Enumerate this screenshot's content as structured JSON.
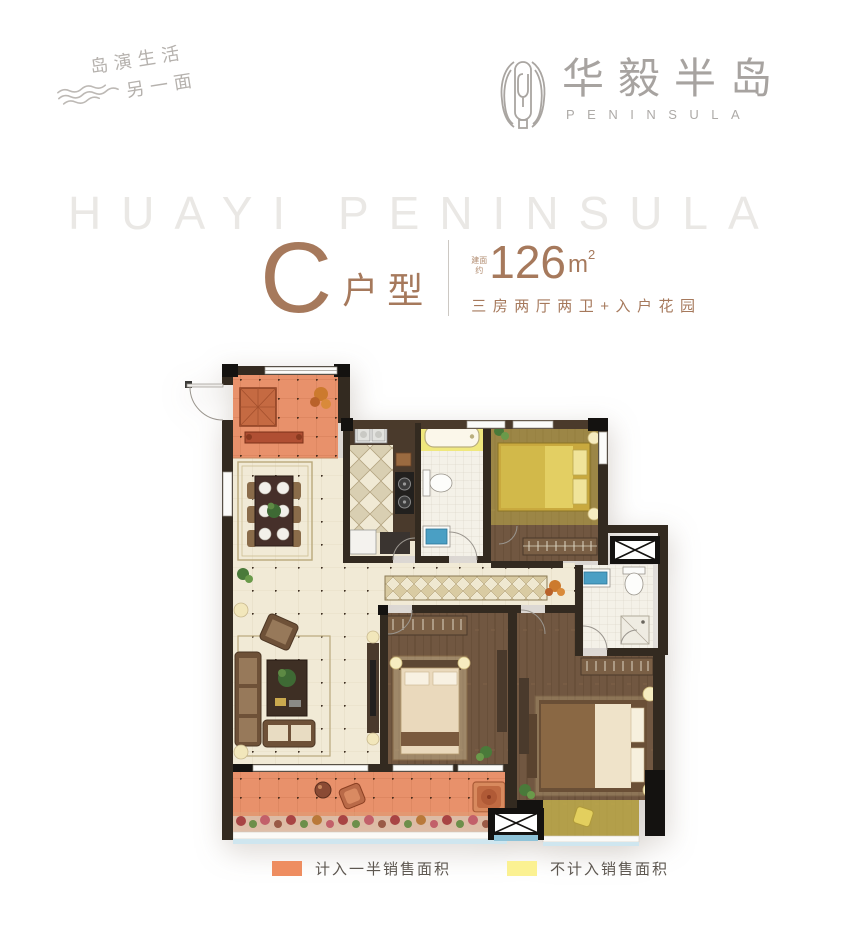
{
  "brand": {
    "tagline_line1": "岛演生活",
    "tagline_line2": "另一面",
    "logo_text": "华毅半岛",
    "logo_subtext": "PENINSULA"
  },
  "watermark": {
    "text": "HUAYI PENINSULA"
  },
  "unit": {
    "letter": "C",
    "type_label": "户型",
    "area_prefix_line1": "建面",
    "area_prefix_line2": "约",
    "area_value": "126",
    "area_unit": "m",
    "area_sup": "2",
    "subtitle": "三房两厅两卫+入户花园"
  },
  "legend": {
    "items": [
      {
        "label": "计入一半销售面积",
        "color": "#ee8d60"
      },
      {
        "label": "不计入销售面积",
        "color": "#fbf192"
      }
    ]
  },
  "floorplan": {
    "colors": {
      "half_sale_area": "#e8916b",
      "excluded_area": "#e2d35e",
      "wall": "#332a20",
      "wood_floor": "#715741",
      "cream_tile": "#f1ead6",
      "fixture_blue": "#4a9fc4"
    }
  }
}
